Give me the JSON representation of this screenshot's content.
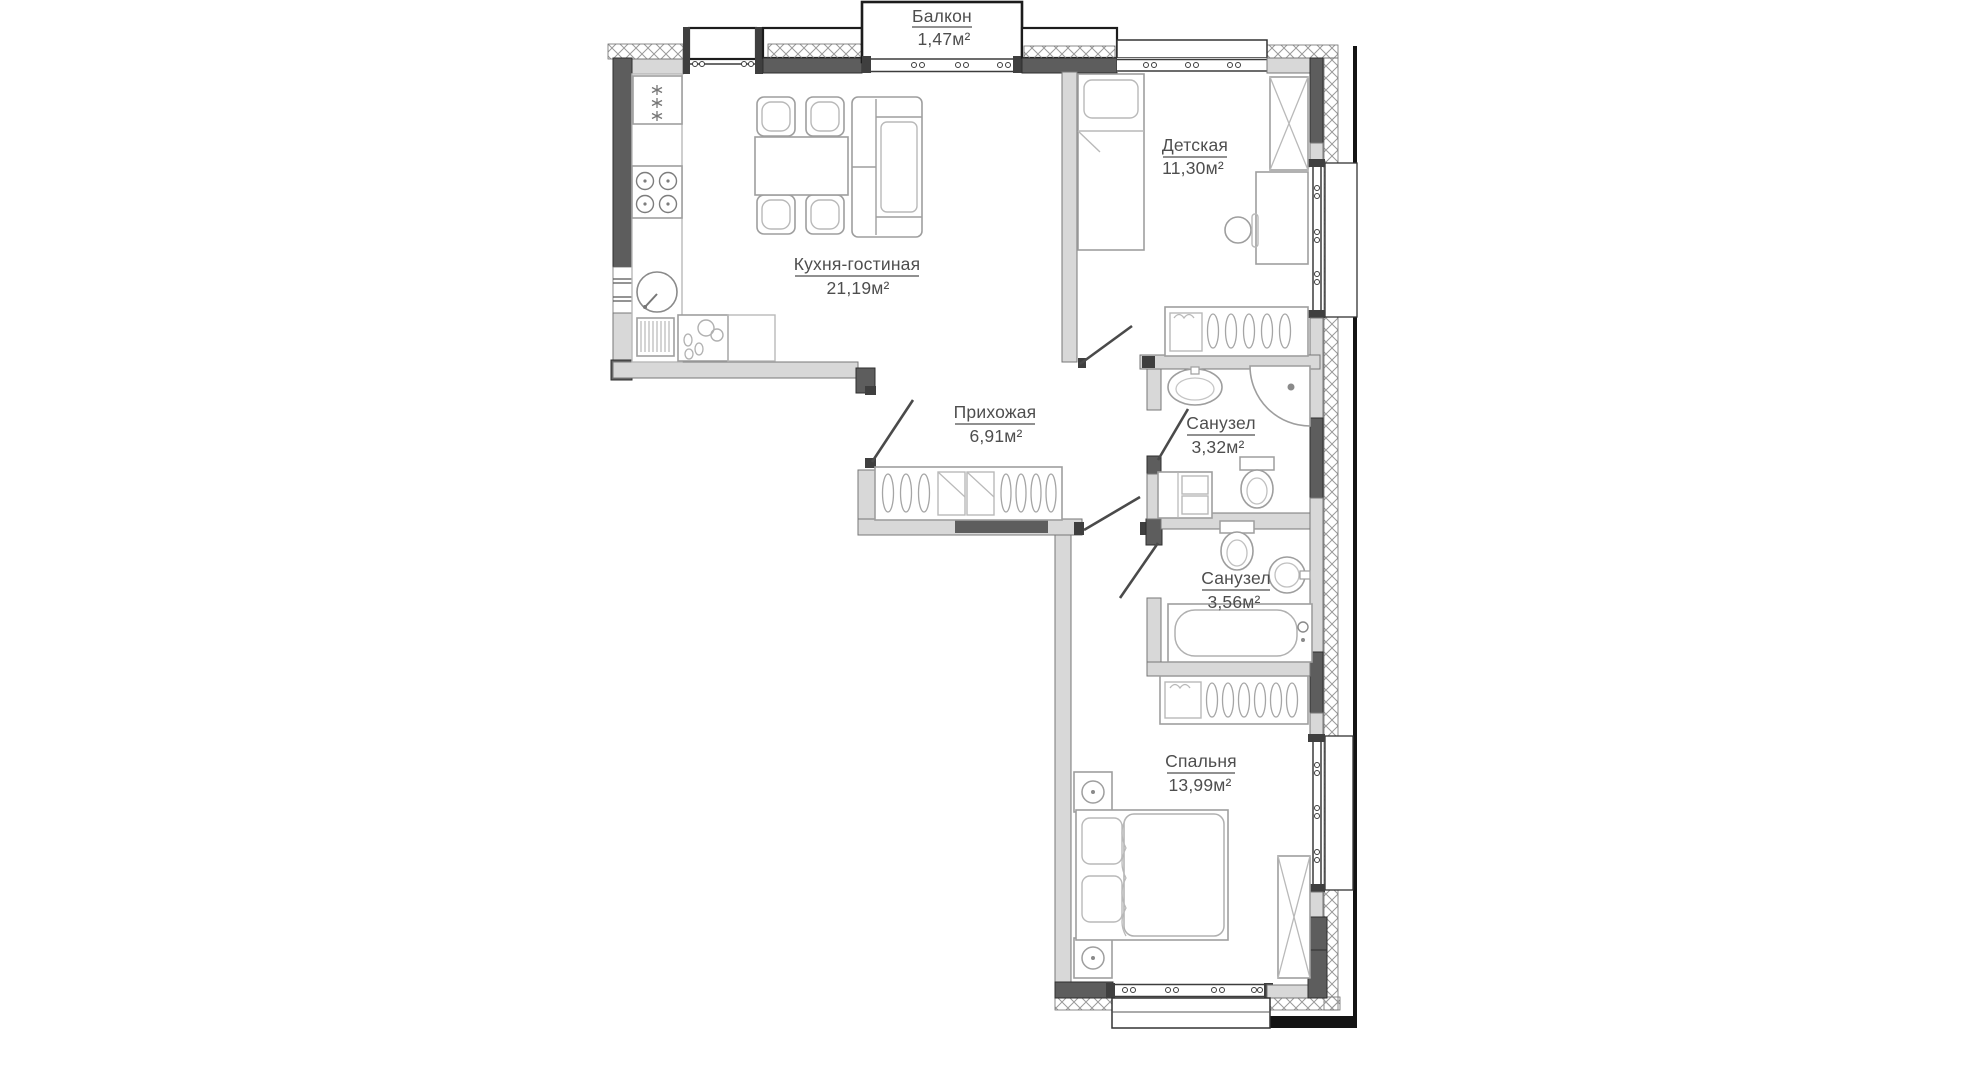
{
  "plan": {
    "rooms": [
      {
        "id": "balcony",
        "name": "Балкон",
        "area": "1,47м²"
      },
      {
        "id": "kitchen-living",
        "name": "Кухня-гостиная",
        "area": "21,19м²"
      },
      {
        "id": "children-room",
        "name": "Детская",
        "area": "11,30м²"
      },
      {
        "id": "hallway",
        "name": "Прихожая",
        "area": "6,91м²"
      },
      {
        "id": "bathroom-1",
        "name": "Санузел",
        "area": "3,32м²"
      },
      {
        "id": "bathroom-2",
        "name": "Санузел",
        "area": "3,56м²"
      },
      {
        "id": "bedroom",
        "name": "Спальня",
        "area": "13,99м²"
      }
    ],
    "colors": {
      "background": "#ffffff",
      "wall_dark": "#5d5d5d",
      "wall_light": "#d8d8d8",
      "outline": "#1c1c1c",
      "furniture_stroke": "#9e9e9e",
      "label_text": "#4e4e4e",
      "hatch": "#9a9a9a"
    },
    "fixtures": [
      "fridge-icon",
      "stove-icon",
      "kitchen-sink-icon",
      "washer-icon",
      "dishwasher-icon",
      "dining-table",
      "dining-chair",
      "sofa",
      "single-bed",
      "wardrobe-icon",
      "desk",
      "desk-chair",
      "closet-hangers",
      "entry-door",
      "bath-sink-icon",
      "shower-icon",
      "toilet-icon",
      "bathroom-cabinet",
      "bathtub-icon",
      "double-bed",
      "nightstand-icon",
      "window",
      "balcony"
    ]
  }
}
